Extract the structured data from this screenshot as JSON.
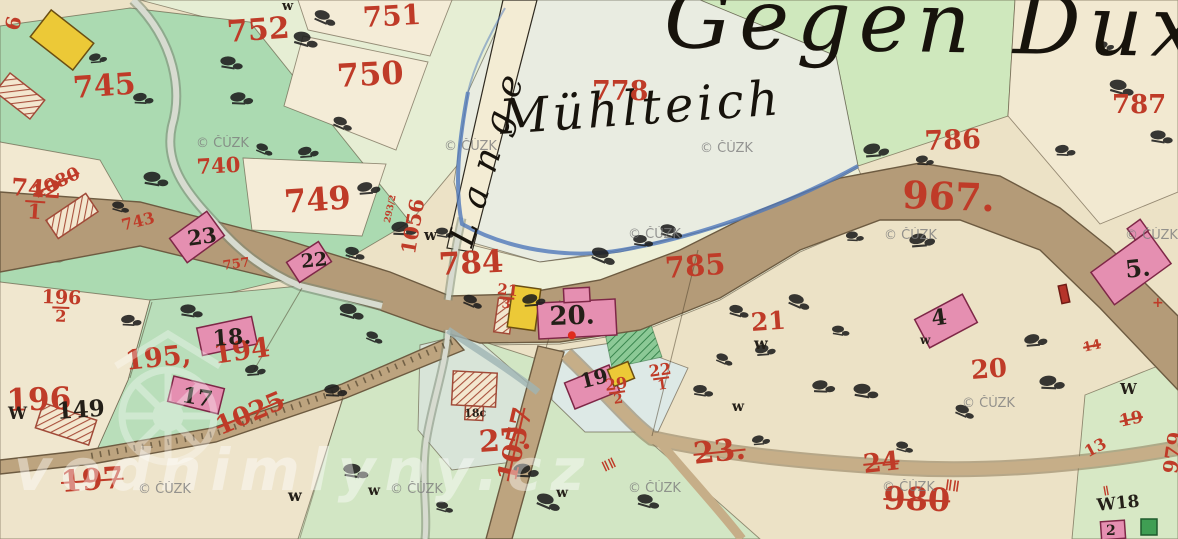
{
  "palette": {
    "paper": "#ece2c6",
    "meadow": "#abdab1",
    "meadow_low": "#b9deba",
    "meadow_pale": "#d2e6c4",
    "field_green": "#e6eed4",
    "gegen_green": "#cfe8bd",
    "pond": "#e9ece1",
    "water_edge": "#4f78ba",
    "road": "#b49b78",
    "road_edge": "#6d5b41",
    "building_pink": "#e58fb1",
    "building_edge": "#7e2747",
    "building_yellow": "#ecc937",
    "ink_red": "#bf3b28",
    "ink_black": "#241f18",
    "stream": "#d7dbd0",
    "watermark_gray": "#7d7d7d"
  },
  "map": {
    "labels": [
      {
        "name": "label-gegen-dux",
        "text": "Gegen Dux",
        "x": 665,
        "y": -24,
        "size": 84,
        "color": "cursive",
        "rot": 1,
        "ls": 8
      },
      {
        "name": "label-muhlteich",
        "text": "Mühlteich",
        "x": 498,
        "y": 94,
        "size": 48,
        "color": "cursive",
        "rot": -4,
        "ls": 4
      },
      {
        "name": "label-lange",
        "text": "Lange",
        "x": 444,
        "y": 240,
        "size": 36,
        "color": "cursive",
        "rot": -73,
        "ls": 16
      },
      {
        "name": "parcel-778",
        "text": "778",
        "x": 592,
        "y": 78,
        "size": 27,
        "color": "red",
        "rot": 0
      },
      {
        "name": "parcel-752",
        "text": "752",
        "x": 226,
        "y": 18,
        "size": 30,
        "color": "red",
        "rot": -4
      },
      {
        "name": "parcel-751",
        "text": "751",
        "x": 362,
        "y": 4,
        "size": 28,
        "color": "red",
        "rot": -3
      },
      {
        "name": "parcel-750",
        "text": "750",
        "x": 336,
        "y": 60,
        "size": 32,
        "color": "red",
        "rot": -3
      },
      {
        "name": "parcel-745",
        "text": "745",
        "x": 72,
        "y": 74,
        "size": 30,
        "color": "red",
        "rot": -4
      },
      {
        "name": "parcel-749",
        "text": "749",
        "x": 283,
        "y": 186,
        "size": 32,
        "color": "red",
        "rot": -4
      },
      {
        "name": "parcel-740",
        "text": "740",
        "x": 196,
        "y": 156,
        "size": 21,
        "color": "red",
        "rot": -3
      },
      {
        "name": "parcel-742-1",
        "text": "742",
        "den": "1",
        "x": 12,
        "y": 176,
        "size": 24,
        "color": "red",
        "rot": 4
      },
      {
        "name": "parcel-743",
        "text": "743",
        "x": 120,
        "y": 218,
        "size": 16,
        "color": "red",
        "rot": -14
      },
      {
        "name": "parcel-757",
        "text": "757",
        "x": 222,
        "y": 260,
        "size": 13,
        "color": "red",
        "rot": -8
      },
      {
        "name": "parcel-786",
        "text": "786",
        "x": 924,
        "y": 128,
        "size": 27,
        "color": "red",
        "rot": -2
      },
      {
        "name": "parcel-787",
        "text": "787",
        "x": 1112,
        "y": 92,
        "size": 26,
        "color": "red",
        "rot": 0
      },
      {
        "name": "road-967",
        "text": "967.",
        "x": 903,
        "y": 176,
        "size": 38,
        "color": "red",
        "rot": 2
      },
      {
        "name": "parcel-784",
        "text": "784",
        "x": 438,
        "y": 250,
        "size": 31,
        "color": "red",
        "rot": -3
      },
      {
        "name": "parcel-785",
        "text": "785",
        "x": 664,
        "y": 254,
        "size": 29,
        "color": "red",
        "rot": -4
      },
      {
        "name": "road-1056",
        "text": "1056",
        "x": 398,
        "y": 252,
        "size": 20,
        "color": "red",
        "rot": -80
      },
      {
        "name": "parcel-293-2",
        "text": "293/2",
        "x": 384,
        "y": 222,
        "size": 9,
        "color": "red",
        "rot": -78
      },
      {
        "name": "road-1080",
        "text": "1080",
        "x": 30,
        "y": 186,
        "size": 18,
        "color": "red",
        "rot": -25,
        "strike": true
      },
      {
        "name": "parcel-196-2",
        "text": "196",
        "den": "2",
        "x": 42,
        "y": 288,
        "size": 19,
        "color": "red",
        "rot": 2
      },
      {
        "name": "parcel-196",
        "text": "196",
        "x": 6,
        "y": 386,
        "size": 31,
        "color": "red",
        "rot": -2
      },
      {
        "name": "parcel-195",
        "text": "195,",
        "x": 124,
        "y": 348,
        "size": 27,
        "color": "red",
        "rot": -6
      },
      {
        "name": "parcel-194",
        "text": "194",
        "x": 212,
        "y": 342,
        "size": 27,
        "color": "red",
        "rot": -8
      },
      {
        "name": "house-149",
        "text": "149",
        "x": 56,
        "y": 400,
        "size": 23,
        "color": "black",
        "rot": -4
      },
      {
        "name": "road-1025",
        "text": "1025",
        "x": 212,
        "y": 416,
        "size": 26,
        "color": "red",
        "rot": -23,
        "strike": true
      },
      {
        "name": "parcel-197",
        "text": "197",
        "x": 60,
        "y": 468,
        "size": 30,
        "color": "red",
        "rot": -4,
        "strike": true
      },
      {
        "name": "road-1057",
        "text": "1057",
        "x": 494,
        "y": 478,
        "size": 27,
        "color": "red",
        "rot": -77,
        "strike": true
      },
      {
        "name": "parcel-27",
        "text": "27.",
        "x": 478,
        "y": 428,
        "size": 30,
        "color": "red",
        "rot": -4
      },
      {
        "name": "parcel-23",
        "text": "23.",
        "x": 692,
        "y": 440,
        "size": 30,
        "color": "red",
        "rot": -6,
        "strike": true
      },
      {
        "name": "parcel-24",
        "text": "24",
        "x": 862,
        "y": 452,
        "size": 26,
        "color": "red",
        "rot": -6,
        "strike": true
      },
      {
        "name": "road-980",
        "text": "980",
        "x": 884,
        "y": 482,
        "size": 32,
        "color": "red",
        "rot": 2,
        "strike": true
      },
      {
        "name": "parcel-21",
        "text": "21",
        "x": 750,
        "y": 310,
        "size": 25,
        "color": "red",
        "rot": -4
      },
      {
        "name": "parcel-20",
        "text": "20",
        "x": 970,
        "y": 358,
        "size": 26,
        "color": "red",
        "rot": -4
      },
      {
        "name": "parcel-29-2",
        "text": "29",
        "den": "2",
        "x": 604,
        "y": 378,
        "size": 16,
        "color": "red",
        "rot": -8
      },
      {
        "name": "parcel-22-1",
        "text": "22",
        "den": "1",
        "x": 648,
        "y": 364,
        "size": 16,
        "color": "red",
        "rot": -8
      },
      {
        "name": "parcel-21-3",
        "text": "21",
        "den": "3",
        "x": 498,
        "y": 282,
        "size": 15,
        "color": "red",
        "rot": 6
      },
      {
        "name": "house-6",
        "text": "6",
        "x": 2,
        "y": 28,
        "size": 20,
        "color": "red",
        "rot": -78
      },
      {
        "name": "parcel-19-edge",
        "text": "19",
        "x": 1118,
        "y": 414,
        "size": 17,
        "color": "red",
        "rot": -12,
        "strike": true
      },
      {
        "name": "parcel-13-edge",
        "text": "13",
        "x": 1082,
        "y": 446,
        "size": 16,
        "color": "red",
        "rot": -28
      },
      {
        "name": "road-979",
        "text": "979",
        "x": 1160,
        "y": 472,
        "size": 20,
        "color": "red",
        "rot": -82
      },
      {
        "name": "parcel-14-edge",
        "text": "14",
        "x": 1082,
        "y": 342,
        "size": 13,
        "color": "red",
        "rot": -12,
        "strike": true
      },
      {
        "name": "mark-cross",
        "text": "+",
        "x": 1152,
        "y": 296,
        "size": 14,
        "color": "red",
        "rot": 0
      },
      {
        "name": "house-23",
        "text": "23",
        "x": 186,
        "y": 228,
        "size": 21,
        "color": "black",
        "rot": -8
      },
      {
        "name": "house-22",
        "text": "22",
        "x": 300,
        "y": 253,
        "size": 19,
        "color": "black",
        "rot": -6
      },
      {
        "name": "house-18",
        "text": "18.",
        "x": 212,
        "y": 328,
        "size": 22,
        "color": "black",
        "rot": -4
      },
      {
        "name": "house-17",
        "text": "17",
        "x": 184,
        "y": 384,
        "size": 22,
        "color": "black",
        "rot": 10
      },
      {
        "name": "house-19",
        "text": "19",
        "x": 578,
        "y": 372,
        "size": 20,
        "color": "black",
        "rot": -14
      },
      {
        "name": "house-20",
        "text": "20.",
        "x": 549,
        "y": 304,
        "size": 26,
        "color": "black",
        "rot": -2
      },
      {
        "name": "house-4",
        "text": "4",
        "x": 930,
        "y": 308,
        "size": 22,
        "color": "black",
        "rot": -8
      },
      {
        "name": "house-5",
        "text": "5.",
        "x": 1124,
        "y": 258,
        "size": 24,
        "color": "black",
        "rot": -6
      },
      {
        "name": "house-2",
        "text": "2",
        "x": 1106,
        "y": 524,
        "size": 14,
        "color": "black",
        "rot": 0
      },
      {
        "name": "label-18c",
        "text": "18c",
        "x": 464,
        "y": 408,
        "size": 11,
        "color": "black",
        "rot": -2
      },
      {
        "name": "label-w18",
        "text": "W18",
        "x": 1096,
        "y": 498,
        "size": 17,
        "color": "black",
        "rot": -6
      },
      {
        "name": "mark-w-1",
        "text": "w",
        "x": 424,
        "y": 228,
        "size": 15,
        "color": "black",
        "rot": 0
      },
      {
        "name": "mark-w-2",
        "text": "w",
        "x": 754,
        "y": 336,
        "size": 16,
        "color": "black",
        "rot": 0
      },
      {
        "name": "mark-w-3",
        "text": "W",
        "x": 8,
        "y": 406,
        "size": 17,
        "color": "black",
        "rot": 0
      },
      {
        "name": "mark-w-4",
        "text": "w",
        "x": 288,
        "y": 488,
        "size": 16,
        "color": "black",
        "rot": 0
      },
      {
        "name": "mark-w-5",
        "text": "w",
        "x": 368,
        "y": 484,
        "size": 14,
        "color": "black",
        "rot": 0
      },
      {
        "name": "mark-w-6",
        "text": "w",
        "x": 732,
        "y": 400,
        "size": 14,
        "color": "black",
        "rot": 0
      },
      {
        "name": "mark-w-7",
        "text": "W",
        "x": 1120,
        "y": 382,
        "size": 15,
        "color": "black",
        "rot": 0
      },
      {
        "name": "mark-w-8",
        "text": "w",
        "x": 282,
        "y": 0,
        "size": 13,
        "color": "black",
        "rot": 0
      },
      {
        "name": "mark-w-9",
        "text": "w",
        "x": 556,
        "y": 486,
        "size": 14,
        "color": "black",
        "rot": 0
      },
      {
        "name": "mark-w-10",
        "text": "w",
        "x": 920,
        "y": 334,
        "size": 12,
        "color": "black",
        "rot": 0
      },
      {
        "name": "mark-hash-1",
        "text": "ǁǁ",
        "x": 600,
        "y": 462,
        "size": 14,
        "color": "red",
        "rot": -25
      },
      {
        "name": "mark-hash-2",
        "text": "ǁǁ",
        "x": 946,
        "y": 478,
        "size": 15,
        "color": "red",
        "rot": 8
      },
      {
        "name": "mark-hash-3",
        "text": "ǁ",
        "x": 1102,
        "y": 486,
        "size": 13,
        "color": "red",
        "rot": -10
      }
    ],
    "trees": [
      [
        95,
        58
      ],
      [
        140,
        98
      ],
      [
        228,
        62
      ],
      [
        302,
        38
      ],
      [
        262,
        148
      ],
      [
        305,
        152
      ],
      [
        238,
        98
      ],
      [
        152,
        178
      ],
      [
        118,
        206
      ],
      [
        340,
        122
      ],
      [
        365,
        188
      ],
      [
        400,
        228
      ],
      [
        442,
        232
      ],
      [
        352,
        252
      ],
      [
        322,
        16
      ],
      [
        872,
        150
      ],
      [
        922,
        160
      ],
      [
        640,
        240
      ],
      [
        668,
        230
      ],
      [
        600,
        254
      ],
      [
        1102,
        46
      ],
      [
        1062,
        150
      ],
      [
        1158,
        136
      ],
      [
        1118,
        86
      ],
      [
        722,
        358
      ],
      [
        762,
        350
      ],
      [
        820,
        386
      ],
      [
        862,
        390
      ],
      [
        902,
        446
      ],
      [
        962,
        410
      ],
      [
        1032,
        340
      ],
      [
        1048,
        382
      ],
      [
        838,
        330
      ],
      [
        736,
        310
      ],
      [
        796,
        300
      ],
      [
        918,
        240
      ],
      [
        852,
        236
      ],
      [
        700,
        390
      ],
      [
        645,
        500
      ],
      [
        545,
        500
      ],
      [
        758,
        440
      ],
      [
        128,
        320
      ],
      [
        188,
        310
      ],
      [
        348,
        310
      ],
      [
        372,
        336
      ],
      [
        252,
        370
      ],
      [
        332,
        390
      ],
      [
        352,
        470
      ],
      [
        442,
        506
      ],
      [
        470,
        300
      ],
      [
        530,
        300
      ],
      [
        522,
        470
      ]
    ]
  },
  "watermarks": {
    "site": "vodnimlyny.cz",
    "copyright": "© ČÚZK",
    "copyright_positions": [
      [
        196,
        136
      ],
      [
        444,
        139
      ],
      [
        700,
        141
      ],
      [
        628,
        227
      ],
      [
        884,
        228
      ],
      [
        1125,
        228
      ],
      [
        962,
        396
      ],
      [
        138,
        482
      ],
      [
        390,
        482
      ],
      [
        628,
        481
      ],
      [
        882,
        480
      ]
    ]
  }
}
